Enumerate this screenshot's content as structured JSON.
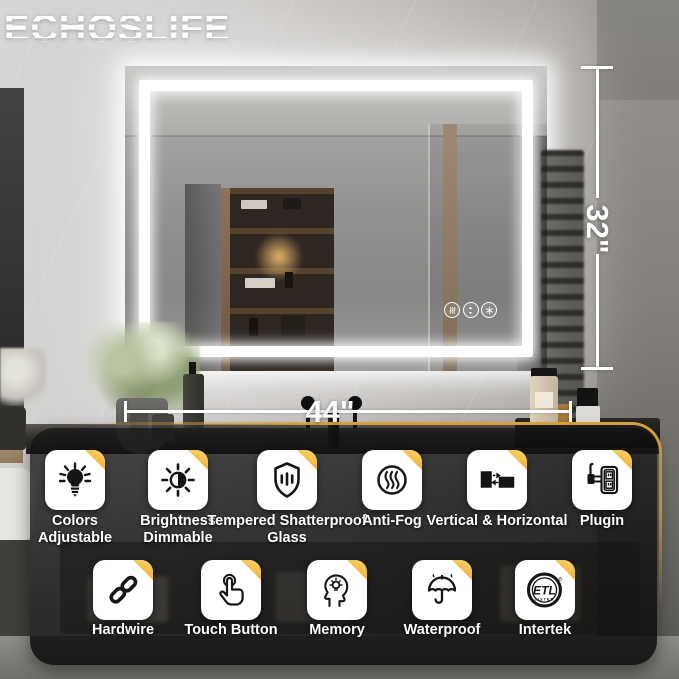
{
  "brand": {
    "logo_text": "ECHOSLIFE"
  },
  "dimensions": {
    "width": "44\"",
    "height": "32\""
  },
  "mirror": {
    "touch_buttons": [
      "defog",
      "brightness-dimmer",
      "color-temperature"
    ]
  },
  "features": {
    "row1": [
      {
        "label": "Colors Adjustable",
        "icon": "color-bulb-icon"
      },
      {
        "label": "Brightness Dimmable",
        "icon": "brightness-icon"
      },
      {
        "label": "Tempered Shatterproof Glass",
        "icon": "shield-glass-icon"
      },
      {
        "label": "Anti-Fog",
        "icon": "anti-fog-icon"
      },
      {
        "label": "Vertical & Horizontal",
        "icon": "orientation-icon"
      },
      {
        "label": "Plugin",
        "icon": "plug-outlet-icon"
      }
    ],
    "row2": [
      {
        "label": "Hardwire",
        "icon": "chain-icon"
      },
      {
        "label": "Touch Button",
        "icon": "touch-hand-icon"
      },
      {
        "label": "Memory",
        "icon": "memory-head-icon"
      },
      {
        "label": "Waterproof",
        "icon": "umbrella-icon"
      },
      {
        "label": "Intertek",
        "icon": "etl-listed-icon"
      }
    ]
  },
  "etl_badge": {
    "text": "ETL",
    "subtext": "LISTED",
    "registered": "®"
  },
  "colors": {
    "accent_yellow": "#e2a843",
    "tile_fold": "#f2a72e",
    "led_white": "#ffffff"
  }
}
